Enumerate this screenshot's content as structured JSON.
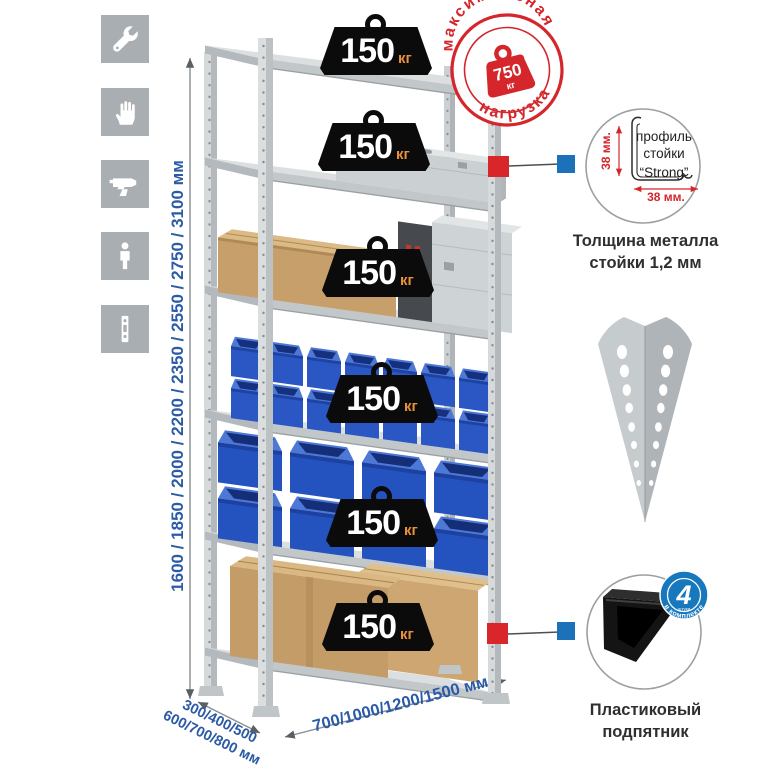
{
  "sidebar": {
    "icons": [
      {
        "name": "wrench-icon"
      },
      {
        "name": "gloves-icon"
      },
      {
        "name": "drill-icon"
      },
      {
        "name": "person-icon"
      },
      {
        "name": "perforated-post-icon"
      }
    ]
  },
  "dimensions": {
    "height_label": "1600 / 1850 / 2000 / 2200 / 2350 / 2550 / 2750 / 3100 мм",
    "depth_line1": "300/400/500",
    "depth_line2": "600/700/800 мм",
    "width_label": "700/1000/1200/1500 мм"
  },
  "rack": {
    "badges": [
      {
        "value": "150",
        "unit": "кг"
      },
      {
        "value": "150",
        "unit": "кг"
      },
      {
        "value": "150",
        "unit": "кг"
      },
      {
        "value": "150",
        "unit": "кг"
      },
      {
        "value": "150",
        "unit": "кг"
      },
      {
        "value": "150",
        "unit": "кг"
      }
    ]
  },
  "max_load_stamp": {
    "arc_top": "максимальная",
    "arc_bottom": "нагрузка",
    "value": "750",
    "unit": "кг"
  },
  "profile_detail": {
    "label_line1": "профиль",
    "label_line2": "стойки",
    "label_line3": "“Strong”",
    "dim_vertical": "38 мм.",
    "dim_horizontal": "38 мм.",
    "caption_line1": "Толщина металла",
    "caption_line2": "стойки 1,2 мм"
  },
  "foot_detail": {
    "badge_value": "4",
    "badge_small": "штуки",
    "badge_arc": "в комплекте",
    "caption_line1": "Пластиковый",
    "caption_line2": "подпятник"
  },
  "colors": {
    "accent_blue": "#2b5aa6",
    "stamp_red": "#d5262c",
    "marker_red": "#d8262b",
    "marker_blue": "#1d71b8",
    "bin_blue": "#2b57c4",
    "badge_blue": "#1878be",
    "weight_black": "#0b0b0b",
    "unit_orange": "#e8913a",
    "icon_gray": "#a9aeb2"
  }
}
